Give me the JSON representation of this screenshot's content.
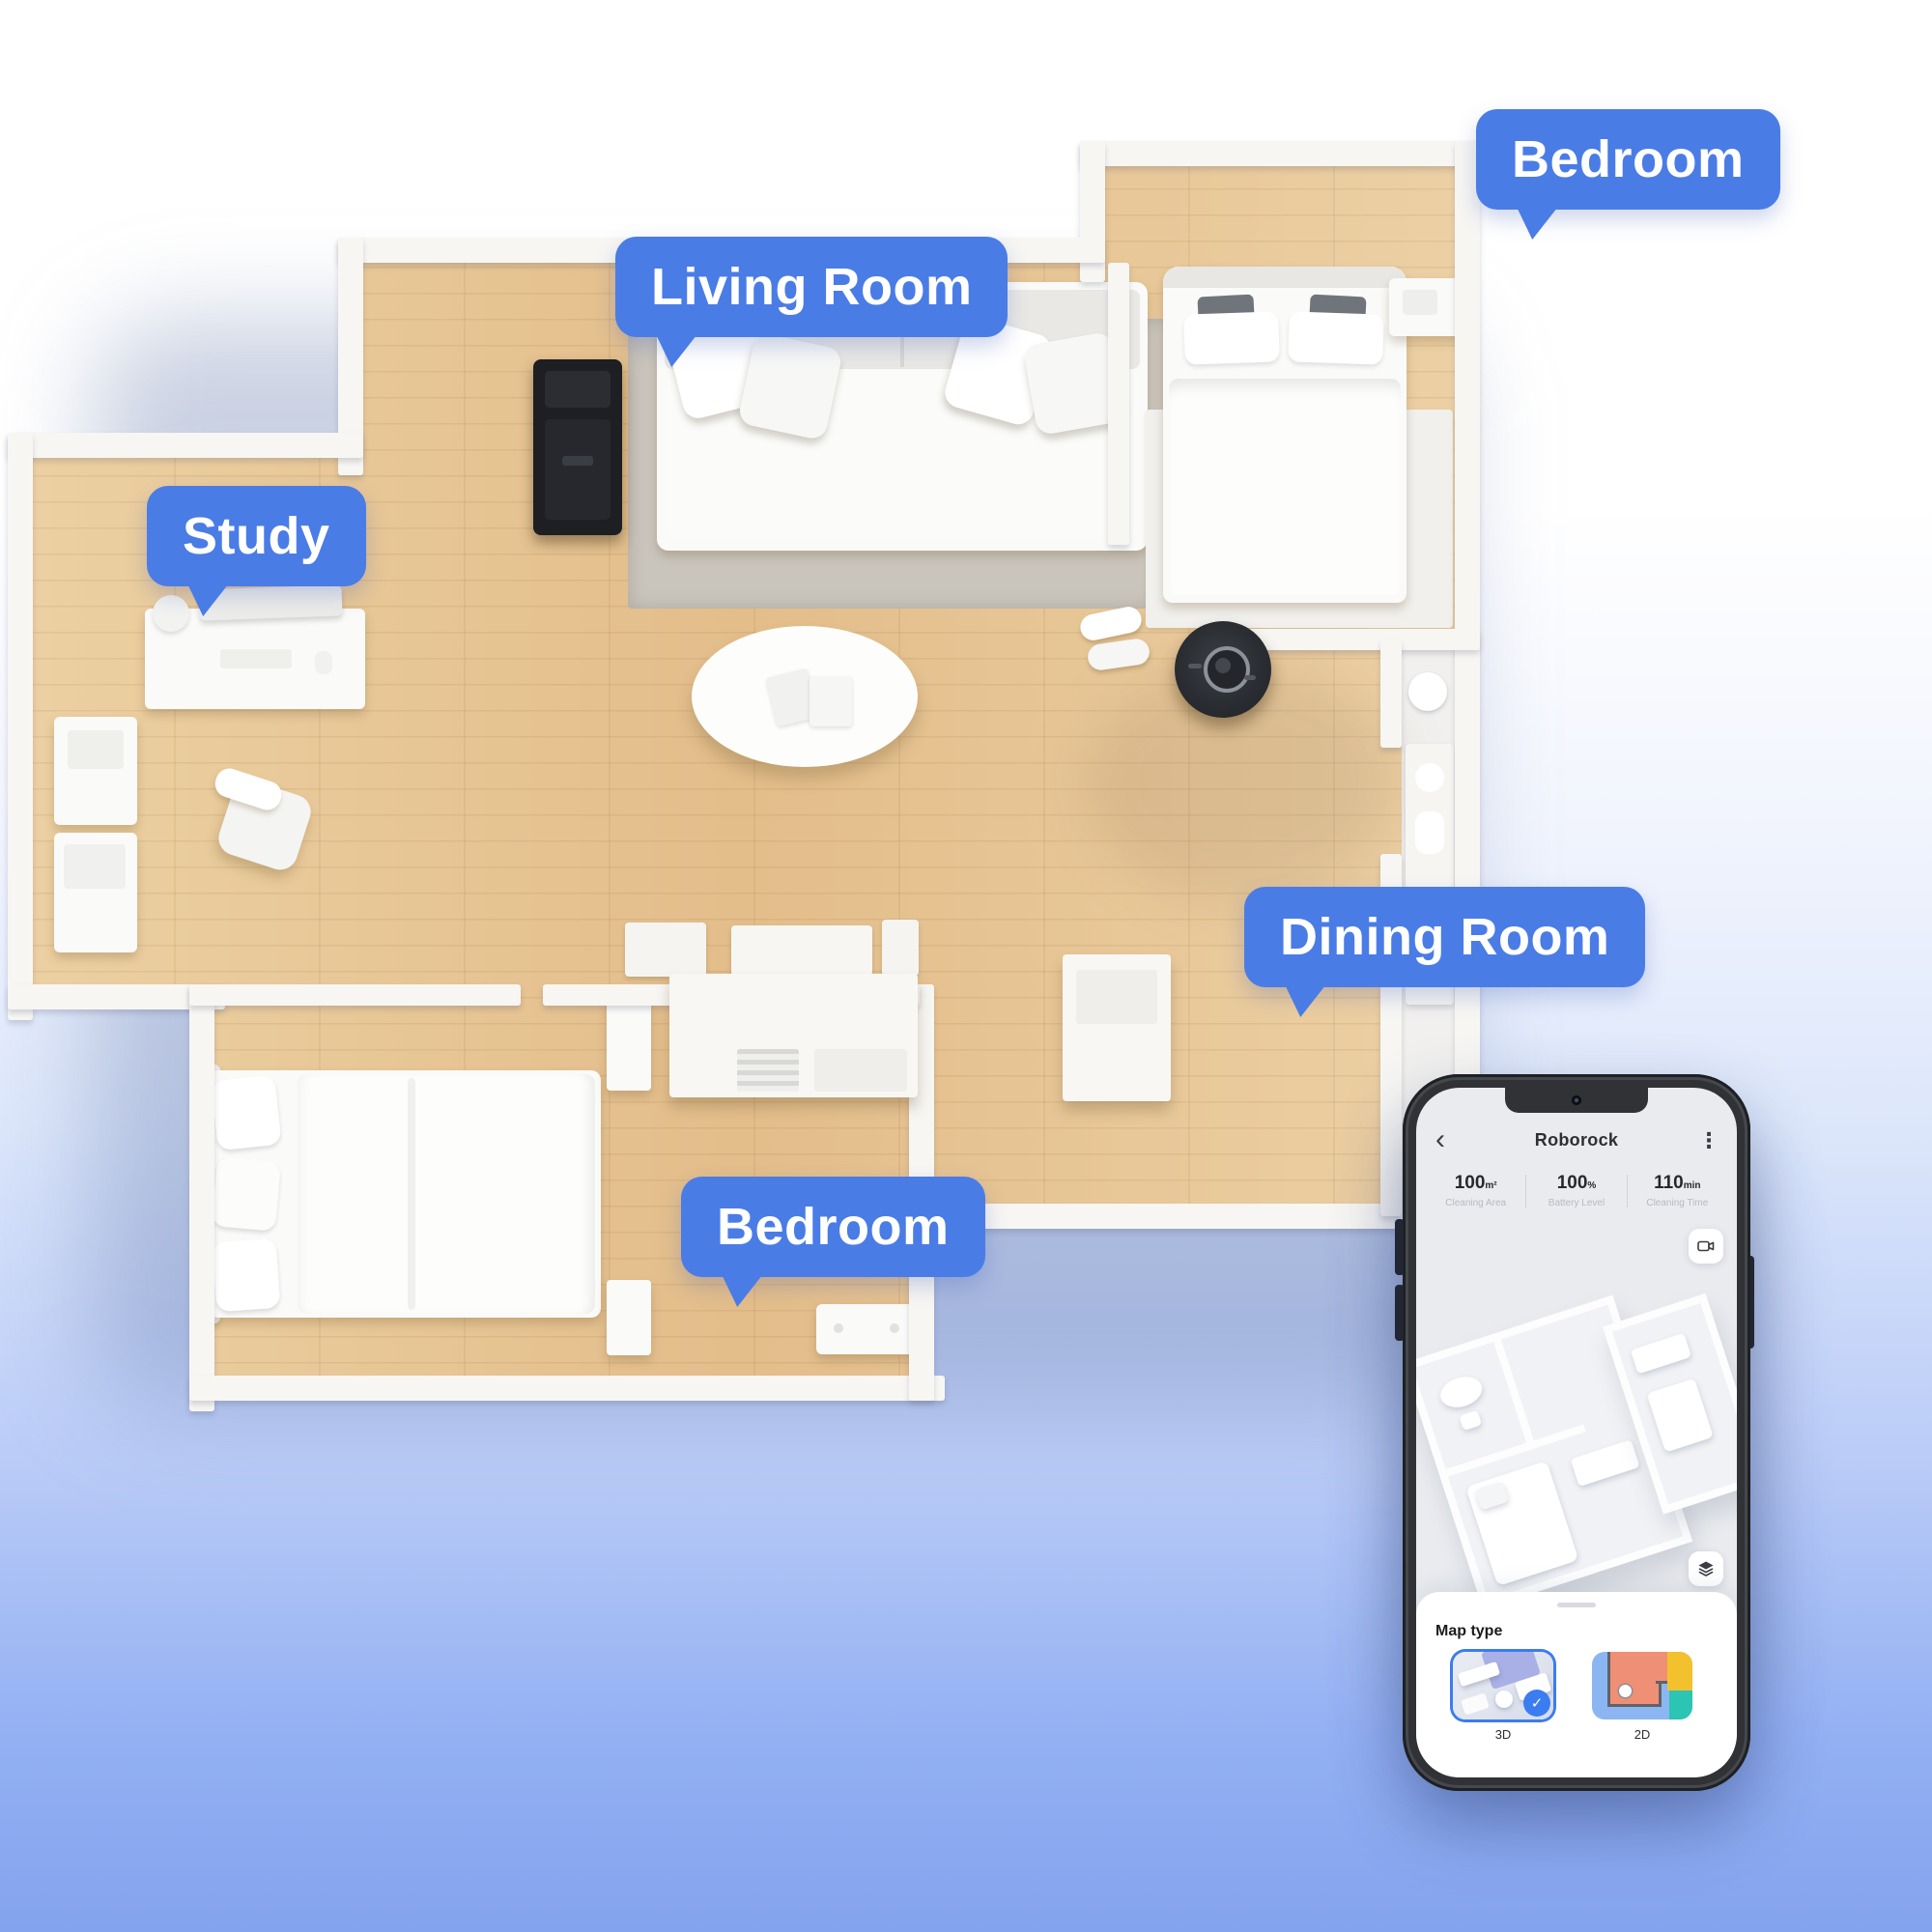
{
  "scene": {
    "labels": {
      "bedroom_top": "Bedroom",
      "living_room": "Living Room",
      "study": "Study",
      "dining_room": "Dining Room",
      "bedroom_bottom": "Bedroom"
    }
  },
  "phone": {
    "title": "Roborock",
    "icons": {
      "back": "‹",
      "more": "⋮",
      "check": "✓"
    },
    "stats": [
      {
        "value": "100",
        "unit": "m²",
        "label": "Cleaning Area"
      },
      {
        "value": "100",
        "unit": "%",
        "label": "Battery Level"
      },
      {
        "value": "110",
        "unit": "min",
        "label": "Cleaning Time"
      }
    ],
    "sheet": {
      "heading": "Map type",
      "options": [
        {
          "label": "3D",
          "selected": true
        },
        {
          "label": "2D",
          "selected": false
        }
      ]
    }
  },
  "colors": {
    "bubble_blue": "#4a7ce6",
    "app_blue": "#3b7cf0",
    "wood": "#e8c695",
    "wall": "#f7f6f3",
    "background_bottom": "#84a3ee"
  }
}
